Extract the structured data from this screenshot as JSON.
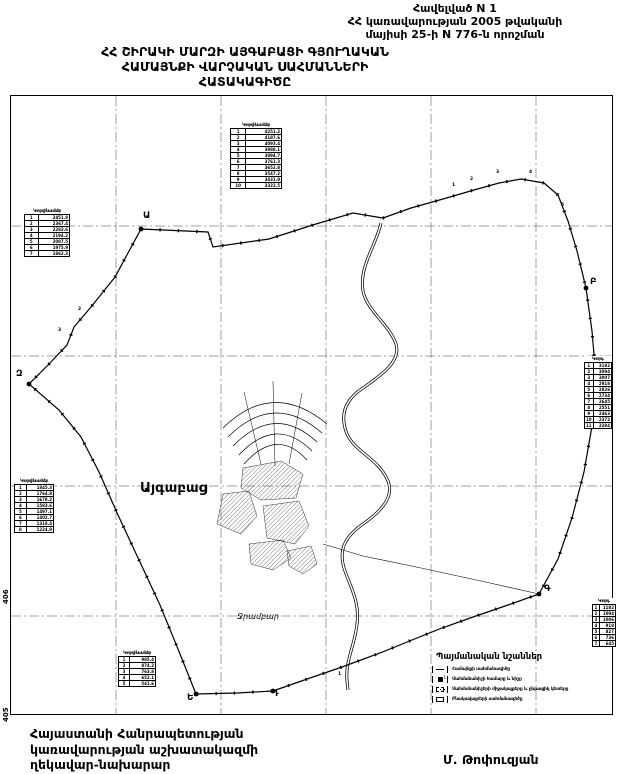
{
  "header": {
    "appendix_lines": [
      "Հավելված N 1",
      "ՀՀ կառավարության 2005 թվականի",
      "մայիսի 25-ի N 776-ն որոշման"
    ]
  },
  "title": {
    "lines": [
      "ՀՀ ՇԻՐԱԿԻ ՄԱՐԶԻ ԱՅԳԱԲԱՑԻ ԳՅՈՒՂԱԿԱՆ",
      "ՀԱՄԱՅՆՔԻ  ՎԱՐՉԱԿԱՆ  ՍԱՀՄԱՆՆԵՐԻ",
      "ՀԱՏԱԿԱԳԻԾԸ"
    ]
  },
  "map": {
    "village_label": "Այգաբաց",
    "reservoir_label": "Ջրամբար",
    "sheet_numbers": [
      "406",
      "405"
    ],
    "vertices": [
      "Ա",
      "Բ",
      "Գ",
      "Դ",
      "Ե",
      "Զ"
    ],
    "ticks": [
      "1",
      "2",
      "3",
      "4",
      "5",
      "2",
      "3",
      "1"
    ],
    "tables": [
      {
        "title": "Կոորդինատներ",
        "rows": [
          [
            "1",
            "4251.2"
          ],
          [
            "2",
            "4187.6"
          ],
          [
            "3",
            "4093.4"
          ],
          [
            "4",
            "3988.1"
          ],
          [
            "5",
            "3894.7"
          ],
          [
            "6",
            "3761.3"
          ],
          [
            "7",
            "3652.8"
          ],
          [
            "8",
            "3547.2"
          ],
          [
            "9",
            "3431.9"
          ],
          [
            "10",
            "3322.5"
          ]
        ]
      },
      {
        "title": "Կոորդինատներ",
        "rows": [
          [
            "1",
            "2451.8"
          ],
          [
            "2",
            "2367.4"
          ],
          [
            "3",
            "2283.6"
          ],
          [
            "4",
            "2194.2"
          ],
          [
            "5",
            "2087.5"
          ],
          [
            "6",
            "1975.9"
          ],
          [
            "7",
            "1862.3"
          ]
        ]
      },
      {
        "title": "Կոորդինատներ",
        "rows": [
          [
            "1",
            "1845.3"
          ],
          [
            "2",
            "1764.8"
          ],
          [
            "3",
            "1678.2"
          ],
          [
            "4",
            "1583.6"
          ],
          [
            "5",
            "1497.1"
          ],
          [
            "6",
            "1402.7"
          ],
          [
            "7",
            "1318.4"
          ],
          [
            "8",
            "1224.9"
          ]
        ]
      },
      {
        "title": "Կոորդինատներ",
        "rows": [
          [
            "1",
            "985.4"
          ],
          [
            "2",
            "874.2"
          ],
          [
            "3",
            "763.8"
          ],
          [
            "4",
            "652.1"
          ],
          [
            "5",
            "541.6"
          ]
        ]
      },
      {
        "title": "Կոորդ.",
        "rows": [
          [
            "1",
            "3182"
          ],
          [
            "2",
            "3094"
          ],
          [
            "3",
            "3007"
          ],
          [
            "4",
            "2918"
          ],
          [
            "5",
            "2826"
          ],
          [
            "6",
            "2734"
          ],
          [
            "7",
            "2645"
          ],
          [
            "8",
            "2551"
          ],
          [
            "9",
            "2463"
          ],
          [
            "10",
            "2372"
          ],
          [
            "11",
            "2284"
          ]
        ]
      },
      {
        "title": "Կոորդ.",
        "rows": [
          [
            "1",
            "1182"
          ],
          [
            "2",
            "1094"
          ],
          [
            "3",
            "1006"
          ],
          [
            "4",
            "918"
          ],
          [
            "5",
            "827"
          ],
          [
            "6",
            "736"
          ],
          [
            "7",
            "645"
          ]
        ]
      }
    ]
  },
  "legend": {
    "title": "Պայմանական նշաններ",
    "items": [
      {
        "label": "Համայնքի սահմանագիծը"
      },
      {
        "label": "Սահմանանիշի համարը և նիշը"
      },
      {
        "label": "Սահմանանիշերի միջակայքերը և ընթացիկ կետերը"
      },
      {
        "label": "Բնակավայրերի սահմանագիծը"
      }
    ]
  },
  "footer": {
    "left_lines": [
      "Հայաստանի Հանրապետության",
      "կառավարության աշխատակազմի",
      "ղեկավար-նախարար"
    ],
    "signature": "Մ. Թոփուզյան"
  },
  "colors": {
    "ink": "#000000",
    "paper": "#ffffff"
  }
}
